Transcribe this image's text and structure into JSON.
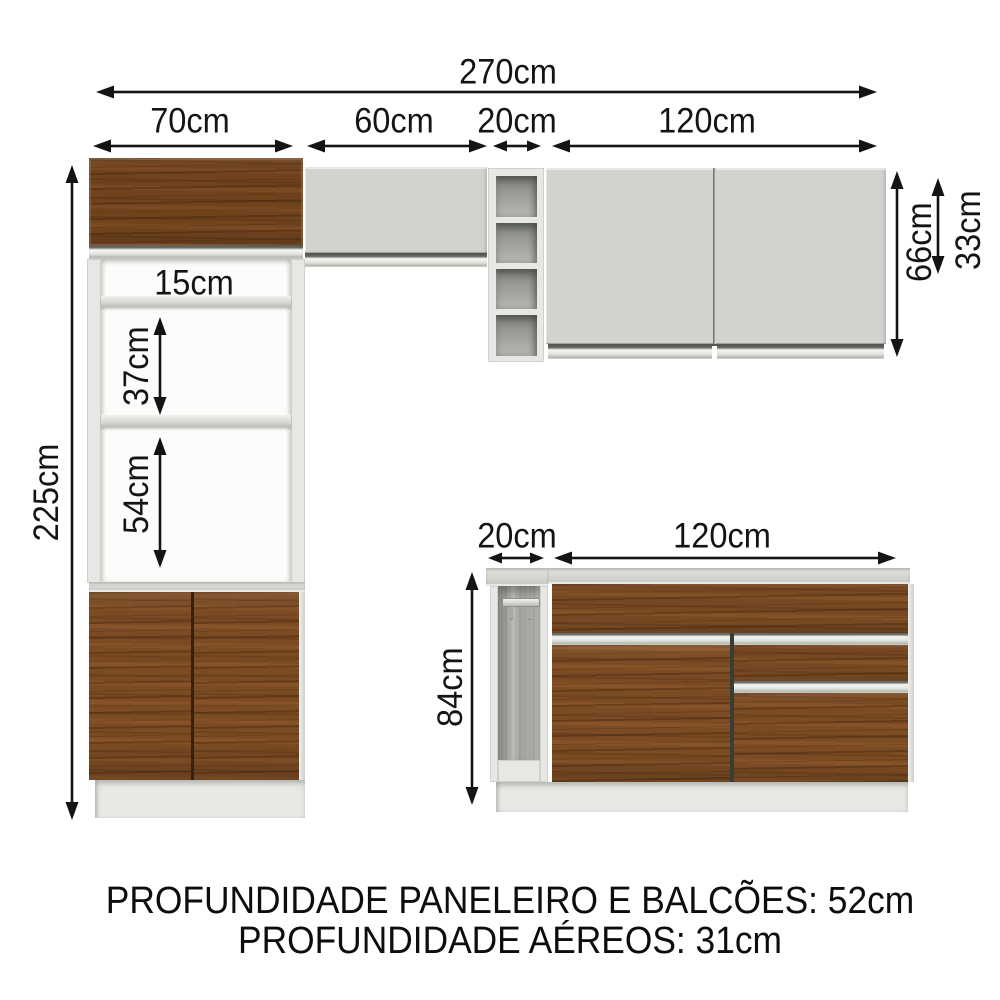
{
  "dimensions": {
    "total_width": "270cm",
    "paneleiro_width": "70cm",
    "upper_60_width": "60cm",
    "upper_niche_width": "20cm",
    "upper_120_width": "120cm",
    "total_height": "225cm",
    "gap_15": "15cm",
    "gap_37": "37cm",
    "gap_54": "54cm",
    "upper_height_66": "66cm",
    "upper_height_33": "33cm",
    "base_niche_width": "20cm",
    "base_counter_width": "120cm",
    "base_height_84": "84cm"
  },
  "footer": {
    "line1": "PROFUNDIDADE PANELEIRO E BALCÕES: 52cm",
    "line2": "PROFUNDIDADE AÉREOS: 31cm"
  },
  "colors": {
    "background": "#ffffff",
    "wood": "#7b4b23",
    "cabinet_offwhite": "#d2d3ce",
    "frame_white": "#e7e8e4",
    "niche_interior": "#9b9e98",
    "arrow": "#141414"
  }
}
